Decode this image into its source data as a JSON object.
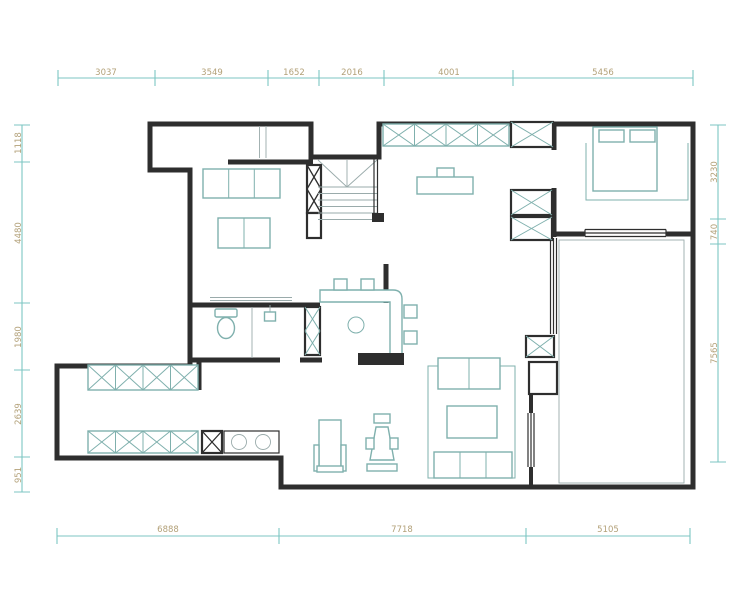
{
  "document_type": "architectural-floor-plan",
  "colors": {
    "background": "#ffffff",
    "wall": "#2e2e2e",
    "dimension_line": "#7cc6c3",
    "dimension_text": "#b3a179",
    "furniture": "#7fb0ad",
    "secondary_lines": "#9aabab"
  },
  "dimensions": {
    "top": [
      "3037",
      "3549",
      "1652",
      "2016",
      "4001",
      "5456"
    ],
    "bottom": [
      "6888",
      "7718",
      "5105"
    ],
    "left": [
      "1118",
      "4480",
      "1980",
      "2639",
      "951"
    ],
    "right": [
      "3230",
      "740",
      "7565"
    ]
  }
}
